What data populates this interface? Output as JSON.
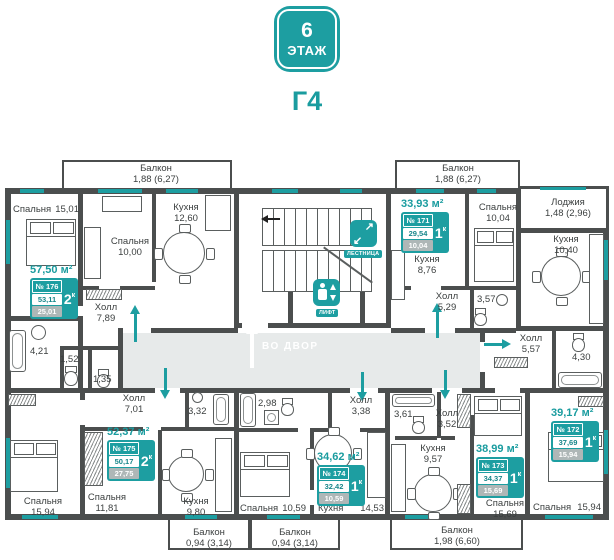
{
  "header": {
    "floor_number": "6",
    "floor_word": "ЭТАЖ",
    "section_label": "Г4"
  },
  "colors": {
    "accent": "#1D9EA1",
    "wall": "#4B4E4E",
    "corridor": "#E7EAEA",
    "card_gray": "#AEB7B7"
  },
  "nav": {
    "stairs": "ЛЕСТНИЦА",
    "elevator": "ЛИФТ",
    "exit": "ВО ДВОР"
  },
  "apartments": [
    {
      "number": "№ 176",
      "rooms": "2",
      "rooms_sup": "к",
      "total_area": "57,50 м²",
      "area_main": "53,11",
      "area_living": "25,01"
    },
    {
      "number": "№ 175",
      "rooms": "2",
      "rooms_sup": "к",
      "total_area": "52,37 м²",
      "area_main": "50,17",
      "area_living": "27,75"
    },
    {
      "number": "№ 174",
      "rooms": "1",
      "rooms_sup": "к",
      "total_area": "34,62 м²",
      "area_main": "32,42",
      "area_living": "10,59"
    },
    {
      "number": "№ 173",
      "rooms": "1",
      "rooms_sup": "к",
      "total_area": "38,99 м²",
      "area_main": "34,37",
      "area_living": "15,69"
    },
    {
      "number": "№ 172",
      "rooms": "1",
      "rooms_sup": "к",
      "total_area": "39,17 м²",
      "area_main": "37,69",
      "area_living": "15,94"
    },
    {
      "number": "№ 171",
      "rooms": "1",
      "rooms_sup": "к",
      "total_area": "33,93 м²",
      "area_main": "29,54",
      "area_living": "10,04"
    }
  ],
  "rooms": [
    {
      "name": "Спальня",
      "area": "15,01"
    },
    {
      "name": "Спальня",
      "area": "10,00"
    },
    {
      "name": "Кухня",
      "area": "12,60"
    },
    {
      "name": "Балкон",
      "area": "1,88 (6,27)"
    },
    {
      "name": "Холл",
      "area": "7,89"
    },
    {
      "name": "",
      "area": "4,21"
    },
    {
      "name": "",
      "area": "1,52"
    },
    {
      "name": "",
      "area": "1,35"
    },
    {
      "name": "Балкон",
      "area": "1,88 (6,27)"
    },
    {
      "name": "Спальня",
      "area": "10,04"
    },
    {
      "name": "Кухня",
      "area": "8,76"
    },
    {
      "name": "Холл",
      "area": "5,29"
    },
    {
      "name": "",
      "area": "3,57"
    },
    {
      "name": "Лоджия",
      "area": "1,48 (2,96)"
    },
    {
      "name": "Кухня",
      "area": "10,40"
    },
    {
      "name": "Холл",
      "area": "5,57"
    },
    {
      "name": "",
      "area": "4,30"
    },
    {
      "name": "Спальня",
      "area": "15,94"
    },
    {
      "name": "Холл",
      "area": "7,01"
    },
    {
      "name": "",
      "area": "3,32"
    },
    {
      "name": "Спальня",
      "area": "15,94"
    },
    {
      "name": "Спальня",
      "area": "11,81"
    },
    {
      "name": "Кухня",
      "area": "9,80"
    },
    {
      "name": "Балкон",
      "area": "0,94 (3,14)"
    },
    {
      "name": "",
      "area": "2,98"
    },
    {
      "name": "Холл",
      "area": "3,38"
    },
    {
      "name": "Спальня",
      "area": "10,59"
    },
    {
      "name": "Кухня",
      "area": "14,53"
    },
    {
      "name": "Балкон",
      "area": "0,94 (3,14)"
    },
    {
      "name": "",
      "area": "3,61"
    },
    {
      "name": "Холл",
      "area": "3,52"
    },
    {
      "name": "Кухня",
      "area": "9,57"
    },
    {
      "name": "Спальня",
      "area": "15,69"
    },
    {
      "name": "Балкон",
      "area": "1,98 (6,60)"
    }
  ]
}
